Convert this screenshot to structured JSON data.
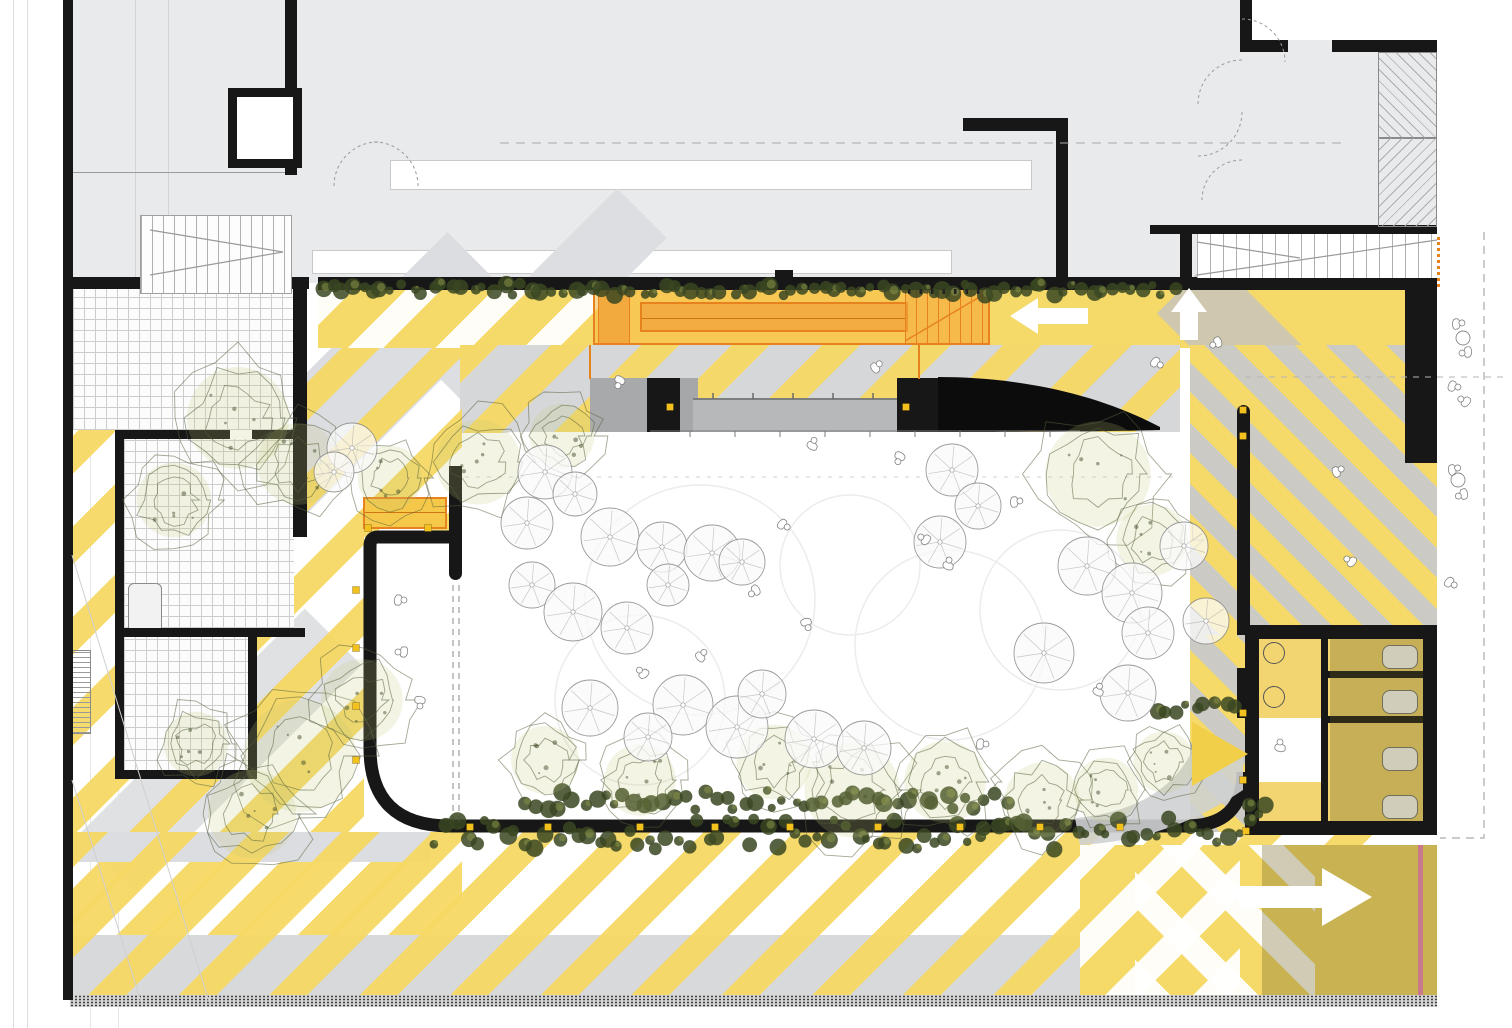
{
  "meta": {
    "drawing": "ground-floor-site-plan",
    "style": "architectural plan with striped public plaza, courtyard, trees and circulation arrows"
  },
  "palette": {
    "paper": "#ffffff",
    "building_gray": "#e9eaec",
    "mid_gray": "#d6d7d9",
    "stage_gray": "#b7b8ba",
    "stripe_yellow": "#f6d864",
    "solid_yellow": "#f5d969",
    "wall_black": "#171717",
    "accent_orange": "#e7821e",
    "orange_fill": "#f4ab41",
    "hedge_green": "#42512a",
    "tree_line": "#566038",
    "canopy_line": "#9a9a9a",
    "marker_yellow": "#f2c11e",
    "pink_line": "#c9798b",
    "olive_shadow": "rgba(99,88,26,0.32)",
    "dash_gray": "#9a9a9a"
  },
  "arrows": [
    {
      "name": "corridor-arrow-left",
      "dir": "left",
      "points": "1010,316 1038,298 1038,308 1088,308 1088,324 1038,324 1038,334",
      "color": "#ffffff"
    },
    {
      "name": "plaza-arrow-up",
      "dir": "up",
      "points": "1189,288 1171,312 1180,312 1180,340 1198,340 1198,312 1207,312",
      "color": "#ffffff"
    },
    {
      "name": "exit-arrow-right",
      "dir": "right",
      "points": "1238,886 1322,886 1322,868 1372,897 1322,926 1322,908 1238,908",
      "color": "#ffffff"
    },
    {
      "name": "door-chevron-right",
      "dir": "right",
      "points": "1192,722 1248,754 1192,786",
      "color": "#f2cf49"
    }
  ],
  "decor": {
    "trees": [
      [
        238,
        418,
        60
      ],
      [
        298,
        464,
        48
      ],
      [
        174,
        500,
        44
      ],
      [
        390,
        478,
        38
      ],
      [
        478,
        462,
        50
      ],
      [
        562,
        436,
        38
      ],
      [
        1098,
        474,
        62
      ],
      [
        1152,
        540,
        42
      ],
      [
        300,
        756,
        66
      ],
      [
        362,
        700,
        48
      ],
      [
        252,
        814,
        52
      ],
      [
        196,
        744,
        38
      ],
      [
        852,
        790,
        56
      ],
      [
        774,
        762,
        44
      ],
      [
        945,
        782,
        48
      ],
      [
        1042,
        800,
        44
      ],
      [
        1106,
        790,
        38
      ],
      [
        1164,
        762,
        36
      ],
      [
        545,
        760,
        40
      ],
      [
        640,
        780,
        42
      ]
    ],
    "canopies": [
      [
        545,
        472,
        27
      ],
      [
        575,
        494,
        22
      ],
      [
        527,
        523,
        26
      ],
      [
        610,
        537,
        29
      ],
      [
        662,
        547,
        25
      ],
      [
        712,
        553,
        28
      ],
      [
        532,
        585,
        23
      ],
      [
        573,
        612,
        29
      ],
      [
        627,
        628,
        26
      ],
      [
        668,
        585,
        21
      ],
      [
        742,
        562,
        23
      ],
      [
        683,
        705,
        30
      ],
      [
        737,
        727,
        31
      ],
      [
        762,
        694,
        24
      ],
      [
        814,
        739,
        29
      ],
      [
        864,
        748,
        27
      ],
      [
        590,
        708,
        28
      ],
      [
        648,
        737,
        24
      ],
      [
        952,
        470,
        26
      ],
      [
        978,
        506,
        23
      ],
      [
        940,
        542,
        26
      ],
      [
        1087,
        566,
        29
      ],
      [
        1132,
        593,
        30
      ],
      [
        1148,
        633,
        26
      ],
      [
        1044,
        653,
        30
      ],
      [
        1128,
        693,
        28
      ],
      [
        1184,
        546,
        24
      ],
      [
        1206,
        621,
        23
      ],
      [
        352,
        448,
        25
      ],
      [
        334,
        472,
        20
      ]
    ],
    "people": [
      [
        812,
        446,
        20
      ],
      [
        900,
        456,
        200
      ],
      [
        782,
        524,
        120
      ],
      [
        926,
        540,
        300
      ],
      [
        1014,
        502,
        80
      ],
      [
        948,
        566,
        10
      ],
      [
        756,
        590,
        230
      ],
      [
        806,
        622,
        160
      ],
      [
        700,
        657,
        40
      ],
      [
        644,
        674,
        310
      ],
      [
        980,
        744,
        90
      ],
      [
        1098,
        692,
        15
      ],
      [
        1155,
        362,
        120
      ],
      [
        1218,
        342,
        240
      ],
      [
        1336,
        472,
        60
      ],
      [
        1352,
        562,
        300
      ],
      [
        398,
        600,
        90
      ],
      [
        404,
        652,
        270
      ],
      [
        420,
        700,
        180
      ],
      [
        1280,
        748,
        0
      ],
      [
        875,
        368,
        45
      ],
      [
        620,
        380,
        200
      ],
      [
        1456,
        324,
        80
      ],
      [
        1468,
        352,
        260
      ],
      [
        1452,
        386,
        100
      ],
      [
        1466,
        402,
        300
      ],
      [
        1452,
        470,
        70
      ],
      [
        1464,
        494,
        250
      ],
      [
        1449,
        582,
        120
      ]
    ],
    "hedges": [
      {
        "x": 318,
        "y": 282,
        "w": 860,
        "h": 15
      },
      {
        "x": 432,
        "y": 814,
        "w": 820,
        "h": 40
      },
      {
        "x": 520,
        "y": 788,
        "w": 490,
        "h": 24
      },
      {
        "x": 1150,
        "y": 700,
        "w": 92,
        "h": 20
      },
      {
        "x": 1246,
        "y": 796,
        "w": 26,
        "h": 24
      }
    ],
    "markers": [
      [
        368,
        528
      ],
      [
        428,
        528
      ],
      [
        356,
        590
      ],
      [
        356,
        648
      ],
      [
        356,
        706
      ],
      [
        356,
        760
      ],
      [
        470,
        827
      ],
      [
        548,
        827
      ],
      [
        640,
        827
      ],
      [
        715,
        827
      ],
      [
        790,
        827
      ],
      [
        878,
        827
      ],
      [
        960,
        827
      ],
      [
        1040,
        827
      ],
      [
        1120,
        827
      ],
      [
        1246,
        831
      ],
      [
        1243,
        713
      ],
      [
        1243,
        780
      ],
      [
        1243,
        410
      ],
      [
        1243,
        436
      ],
      [
        670,
        407
      ],
      [
        906,
        407
      ]
    ],
    "ground_circles": [
      [
        700,
        600,
        115
      ],
      [
        950,
        645,
        95
      ],
      [
        640,
        700,
        85
      ],
      [
        850,
        565,
        70
      ],
      [
        1060,
        610,
        80
      ]
    ],
    "margin_tables": [
      [
        1463,
        338
      ],
      [
        1458,
        480
      ]
    ],
    "stair_ticks": {
      "x": 908,
      "y": 289,
      "count": 7,
      "dx": 11.5
    }
  },
  "fixtures": {
    "toilet_stalls": 4,
    "sinks": 2,
    "benches": 2
  },
  "stairs": {
    "top_left_treads": 13,
    "top_right_treads": 18,
    "ramp_treads": 7
  }
}
